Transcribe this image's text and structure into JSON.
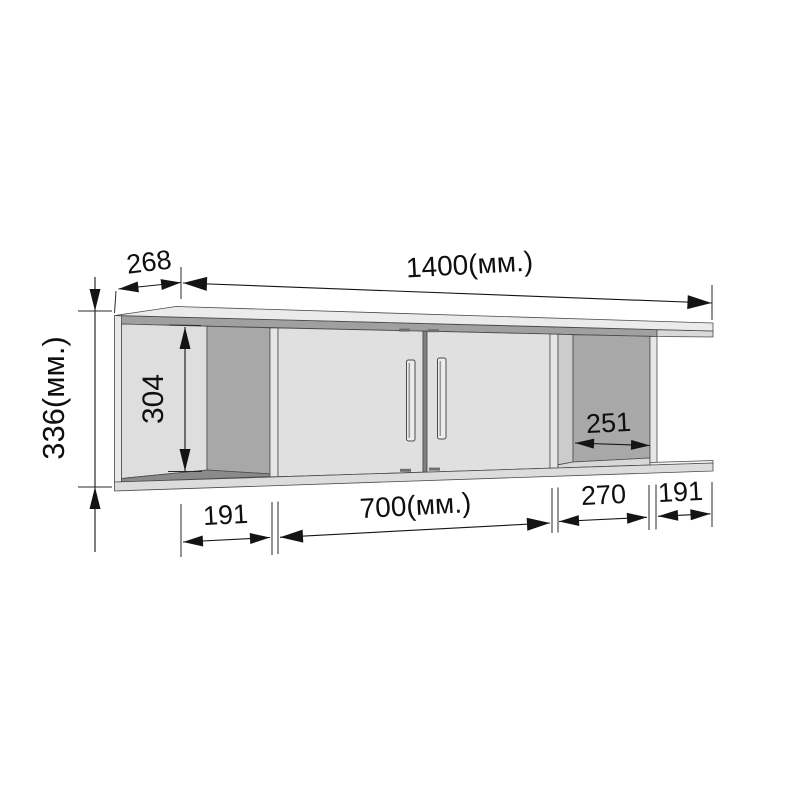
{
  "diagram": {
    "kind": "furniture-dimension-drawing",
    "subject": "wall-mounted shelf cabinet with two doors and open side compartments",
    "unit_suffix": "(мм.)",
    "dims": {
      "depth_top": "268",
      "width_top": "1400(мм.)",
      "height_left": "336(мм.)",
      "inner_height": "304",
      "inner_depth_right": "251",
      "bottom_section_1": "191",
      "bottom_section_2": "700(мм.)",
      "bottom_section_3": "270",
      "bottom_section_4": "191"
    },
    "colors": {
      "background": "#ffffff",
      "panel_light": "#e3e3e3",
      "panel_inner": "#dedede",
      "panel_back_dark": "#a8a8a8",
      "top_underside": "#a0a0a0",
      "outline": "#4b4b4b",
      "dimension": "#141414"
    }
  }
}
